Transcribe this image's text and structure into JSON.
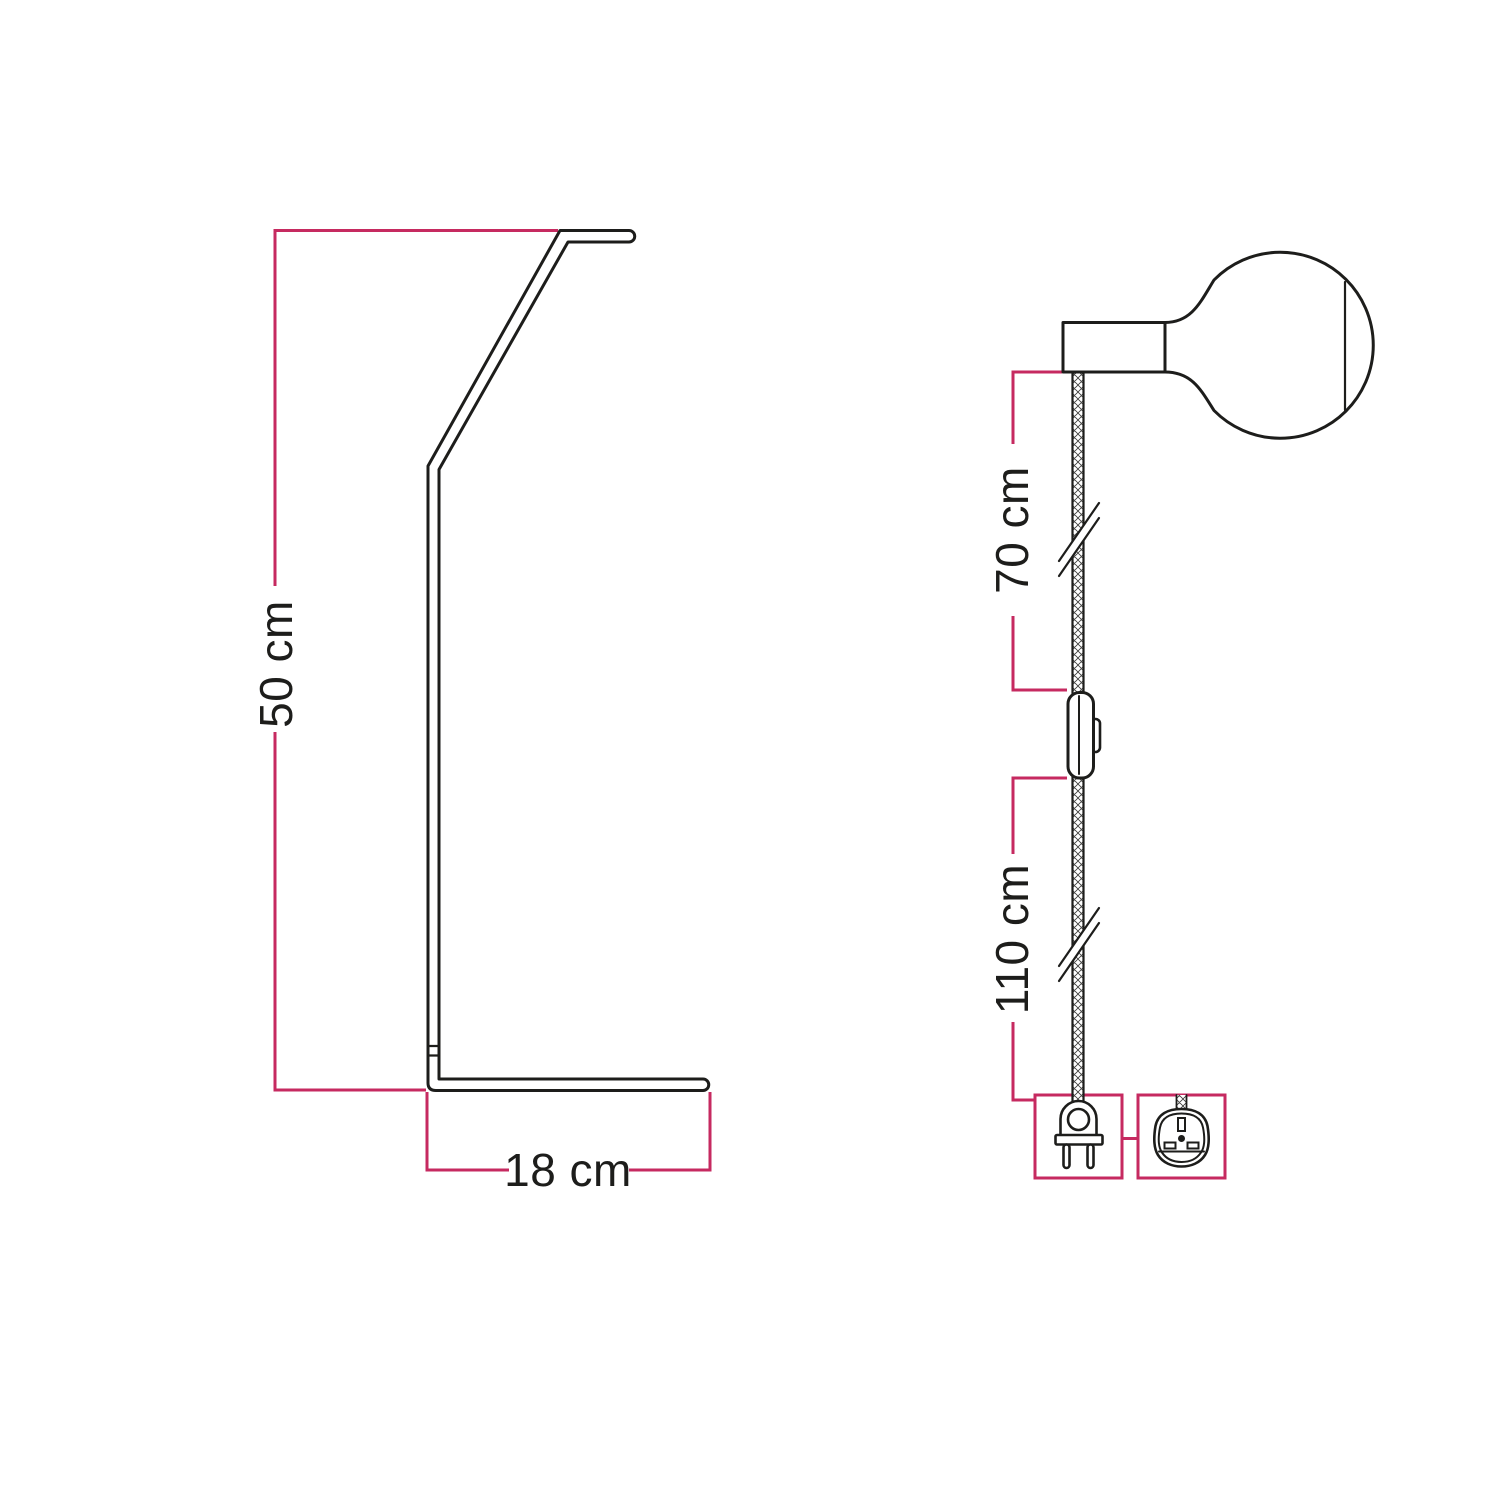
{
  "diagram": {
    "description": "Lamp technical dimension drawing: stand side view and pendant cable with bulb, switch and plugs",
    "background": "#ffffff",
    "line_color": "#1d1d1b",
    "accent_color": "#c62a60",
    "stand_view": {
      "height_label": "50 cm",
      "base_depth_label": "18 cm"
    },
    "pendant_view": {
      "upper_cable_label": "70 cm",
      "lower_cable_label": "110 cm"
    },
    "icons": {
      "bulb": "globe-bulb-icon",
      "lamp_holder": "lamp-holder-icon",
      "switch": "inline-switch-icon",
      "eu_plug": "europlug-two-pin-icon",
      "uk_plug": "uk-three-pin-plug-icon",
      "cable": "braided-cable-texture",
      "break": "cable-break-mark"
    }
  }
}
